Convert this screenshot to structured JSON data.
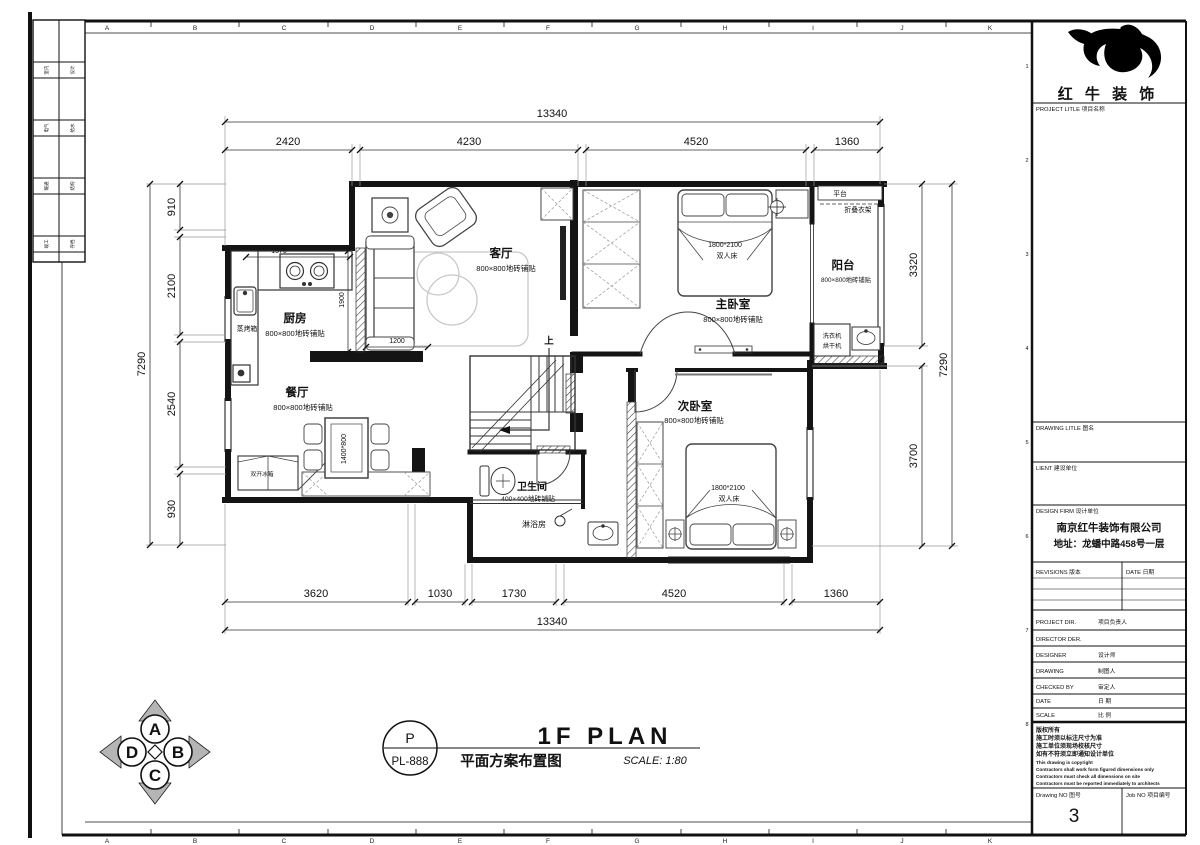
{
  "sheet": {
    "grid_letters": [
      "A",
      "B",
      "C",
      "D",
      "E",
      "F",
      "G",
      "H",
      "I",
      "J",
      "K"
    ],
    "grid_numbers": [
      "1",
      "2",
      "3",
      "4",
      "5",
      "6",
      "7",
      "8"
    ],
    "strip_rows": [
      [
        "室内",
        "设计"
      ],
      [
        "电气",
        "给水"
      ],
      [
        "暖通",
        "结构"
      ],
      [
        "竣工",
        "存档"
      ]
    ]
  },
  "title_block": {
    "brand": "红 牛 装 饰",
    "project_label": "PROJECT LITLE  项目名称",
    "drawing_label": "DRAWING LITLE  图名",
    "client_label": "LIENT  建设单位",
    "design_firm_label": "DESIGN FIRM  设计单位",
    "firm_name": "南京红牛装饰有限公司",
    "firm_addr": "地址：龙蟠中路458号一层",
    "revisions_label": "REVISIONS  版本",
    "date_col_label": "DATE  日期",
    "rows": [
      {
        "en": "PROJECT DIR.",
        "cn": "项目负责人"
      },
      {
        "en": "DIRECTOR DER.",
        "cn": ""
      },
      {
        "en": "DESIGNER",
        "cn": "设计师"
      },
      {
        "en": "DRAWING",
        "cn": "制图人"
      },
      {
        "en": "CHECKED BY",
        "cn": "审定人"
      },
      {
        "en": "DATE",
        "cn": "日  期"
      },
      {
        "en": "SCALE",
        "cn": "比  例"
      }
    ],
    "copyright_cn": [
      "版权所有",
      "施工时须以标注尺寸为准",
      "施工单位须现场校核尺寸",
      "如有不符须立即通知设计单位"
    ],
    "copyright_en": [
      "This drawing is copyright",
      "Contractors shall work form figured dimensions only",
      "Contractors must check all dimensions on site",
      "Contractors must be reported immediately to architects"
    ],
    "drawing_no_label": "Drawing NO  图号",
    "drawing_no": "3",
    "job_no_label": "Job NO  项目编号"
  },
  "titlebar": {
    "code_top": "P",
    "code_bottom": "PL-888",
    "title_cn": "平面方案布置图",
    "title_en": "1F PLAN",
    "scale": "SCALE: 1:80"
  },
  "compass": {
    "n": "A",
    "e": "B",
    "s": "C",
    "w": "D"
  },
  "plan": {
    "rooms": {
      "living": {
        "name": "客厅",
        "note": "800×800地砖铺贴"
      },
      "kitchen": {
        "name": "厨房",
        "note": "800×800地砖铺贴"
      },
      "dining": {
        "name": "餐厅",
        "note": "800×800地砖铺贴"
      },
      "master": {
        "name": "主卧室",
        "note": "800×800地砖铺贴"
      },
      "second": {
        "name": "次卧室",
        "note": "800×800地砖铺贴"
      },
      "bath": {
        "name": "卫生间",
        "note": "400×400地砖铺贴"
      },
      "balcony": {
        "name": "阳台",
        "note": "800×800地砖铺贴"
      }
    },
    "labels": {
      "platform": "平台",
      "rack": "折叠衣架",
      "washer": "洗衣机",
      "dryer": "烘干机",
      "shower": "淋浴房",
      "up": "上",
      "oven": "蒸烤箱",
      "fridge": "双开冰箱",
      "bed_size": "1800*2100",
      "bed_type": "双人床"
    },
    "dims": {
      "top_total": "13340",
      "top": [
        "2420",
        "4230",
        "4520",
        "1360"
      ],
      "bottom": [
        "3620",
        "1030",
        "1730",
        "4520",
        "1360"
      ],
      "bottom_total": "13340",
      "left_total": "7290",
      "left": [
        "910",
        "2100",
        "2540",
        "930"
      ],
      "right": [
        "3320",
        "3700"
      ],
      "right_total": "7290",
      "inner_counter": "1570",
      "inner_depth": "1900",
      "inner_sofa": "1200",
      "inner_table": "1400*800"
    }
  }
}
